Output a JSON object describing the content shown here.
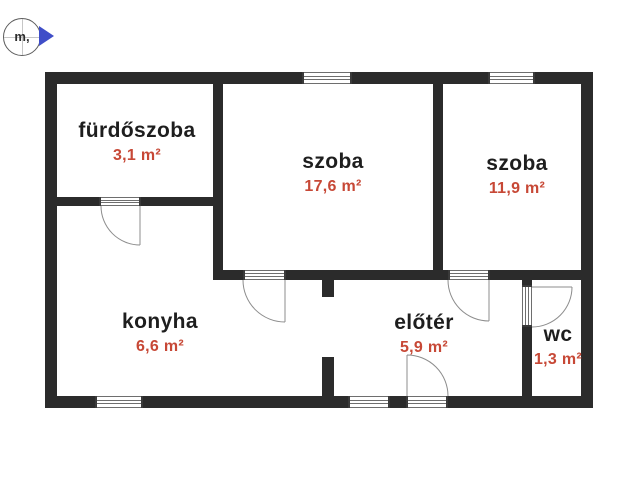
{
  "meta": {
    "kind": "apartment-floor-plan"
  },
  "logo": {
    "label": "m,",
    "arrow_icon": "right-arrow-icon"
  },
  "colors": {
    "wall": "#2b2b2b",
    "area": "#c74836",
    "accent": "#3f4ec8",
    "background": "#ffffff",
    "room_name": "#1e1e1e"
  },
  "rooms": [
    {
      "id": "furdoszoba",
      "name": "fürdőszoba",
      "area": "3,1 m²"
    },
    {
      "id": "szoba-1",
      "name": "szoba",
      "area": "17,6 m²"
    },
    {
      "id": "szoba-2",
      "name": "szoba",
      "area": "11,9 m²"
    },
    {
      "id": "konyha",
      "name": "konyha",
      "area": "6,6 m²"
    },
    {
      "id": "eloter",
      "name": "előtér",
      "area": "5,9 m²"
    },
    {
      "id": "wc",
      "name": "wc",
      "area": "1,3 m²"
    }
  ]
}
